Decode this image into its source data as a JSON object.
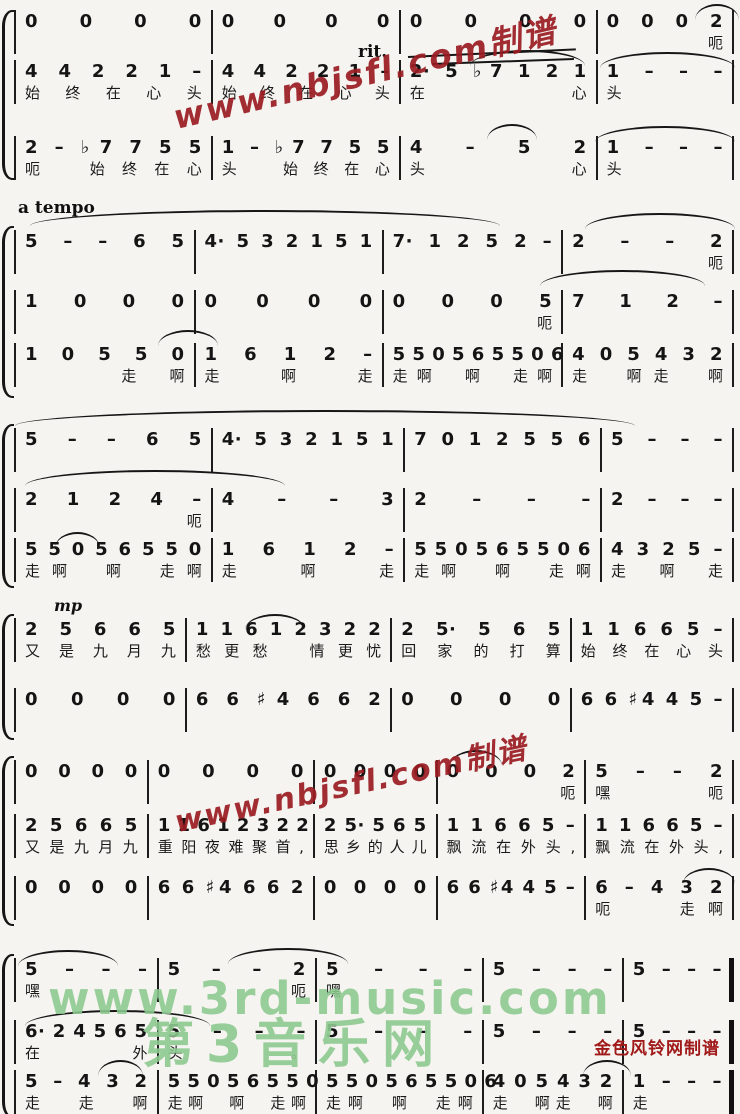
{
  "marks": {
    "rit": "rit.",
    "a_tempo": "a tempo",
    "mp": "mp"
  },
  "watermarks": {
    "red_diagonal_top": "www.nbjsfl.com制谱",
    "red_diagonal_mid": "www.nbjsfl.com制谱",
    "green_url": "www.3rd-music.com",
    "green_site_name": "第3音乐网",
    "red_credit": "金色风铃网制谱"
  },
  "colors": {
    "watermark_red": "#9a1c22",
    "watermark_green": "#8cc98f",
    "notation": "#141414",
    "background": "#f5f4f0"
  },
  "systems": [
    {
      "widths": [
        2.05,
        1.95,
        2.05,
        1.35
      ],
      "voices": [
        {
          "measures": [
            {
              "n": "0 0 0 0"
            },
            {
              "n": "0 0 0 0"
            },
            {
              "n": "0 0 0 0"
            },
            {
              "n": "0 0 0 2",
              "l": "　　　呃"
            }
          ]
        },
        {
          "measures": [
            {
              "n": "4 4 2 2 1 –",
              "l": "始终在心头"
            },
            {
              "n": "4 4 2 2 1 –",
              "l": "始终在心头"
            },
            {
              "n": "2· 5 ♭7 1 2 1",
              "l": "在　　心"
            },
            {
              "n": "1 – – –",
              "l": "头"
            }
          ]
        },
        {
          "measures": [
            {
              "n": "2 – ♭7 7 5 5",
              "l": "呃　始终在心"
            },
            {
              "n": "1 – ♭7 7 5 5",
              "l": "头　始终在心"
            },
            {
              "n": "4 – 5 2",
              "l": "头　心"
            },
            {
              "n": "1 – – –",
              "l": "头"
            }
          ]
        }
      ]
    },
    {
      "widths": [
        1.85,
        1.95,
        1.85,
        1.75
      ],
      "voices": [
        {
          "measures": [
            {
              "n": "5 – – 6 5"
            },
            {
              "n": "4· 5 3 2 1 5 1"
            },
            {
              "n": "7· 1 2 5 2 –"
            },
            {
              "n": "2 – – 2",
              "l": "　　　呃"
            }
          ]
        },
        {
          "measures": [
            {
              "n": "1 0 0 0"
            },
            {
              "n": "0 0 0 0"
            },
            {
              "n": "0 0 0 5",
              "l": "　　　呃"
            },
            {
              "n": "7 1 2 –"
            }
          ]
        },
        {
          "measures": [
            {
              "n": "1 0 5 5 0",
              "l": "　　走啊"
            },
            {
              "n": "1 6 1 2 –",
              "l": "走啊走"
            },
            {
              "n": "5 5 0 5 6 5 5 0 6",
              "l": "走啊　啊　走啊"
            },
            {
              "n": "4 0 5 4 3 2",
              "l": "走　啊走　啊"
            }
          ]
        }
      ]
    },
    {
      "widths": [
        2.05,
        2.0,
        2.05,
        1.3
      ],
      "voices": [
        {
          "measures": [
            {
              "n": "5 – – 6 5"
            },
            {
              "n": "4· 5 3 2 1 5 1"
            },
            {
              "n": "7 0 1 2 5 5 6"
            },
            {
              "n": "5 – – –"
            }
          ]
        },
        {
          "measures": [
            {
              "n": "2 1 2 4 –",
              "l": "　呃"
            },
            {
              "n": "4 – – 3"
            },
            {
              "n": "2 – – –"
            },
            {
              "n": "2 – – –"
            }
          ]
        },
        {
          "measures": [
            {
              "n": "5 5 0 5 6 5 5 0",
              "l": "走啊　啊　走啊"
            },
            {
              "n": "1 6 1 2 –",
              "l": "走啊走"
            },
            {
              "n": "5 5 0 5 6 5 5 0 6",
              "l": "走啊　啊　走啊"
            },
            {
              "n": "4 3 2 5 –",
              "l": "走　啊　走"
            }
          ]
        }
      ]
    },
    {
      "widths": [
        1.75,
        2.15,
        1.85,
        1.65
      ],
      "voices": [
        {
          "measures": [
            {
              "n": "2 5 6 6 5",
              "l": "又是九月九"
            },
            {
              "n": "1 1 6 1 2 3 2 2",
              "l": "愁更愁　情更忧"
            },
            {
              "n": "2 5· 5 6 5",
              "l": "回家的打算"
            },
            {
              "n": "1 1 6 6 5 –",
              "l": "始终在心头"
            }
          ]
        },
        {
          "measures": [
            {
              "n": "0 0 0 0"
            },
            {
              "n": "6 6 ♯4 6 6 2"
            },
            {
              "n": "0 0 0 0"
            },
            {
              "n": "6 6 ♯4 4 5 –"
            }
          ]
        }
      ]
    },
    {
      "widths": [
        1.35,
        1.75,
        1.23,
        1.54,
        1.53
      ],
      "voices": [
        {
          "measures": [
            {
              "n": "0 0 0 0"
            },
            {
              "n": "0 0 0 0"
            },
            {
              "n": "0 0 0 0"
            },
            {
              "n": "0 0 0 2",
              "l": "　　　呃"
            },
            {
              "n": "5 – – 2",
              "l": "嘿　　呃"
            }
          ]
        },
        {
          "measures": [
            {
              "n": "2 5 6 6 5",
              "l": "又是九月九"
            },
            {
              "n": "1 1 6 1 2 3 2 2",
              "l": "重阳夜难聚首,"
            },
            {
              "n": "2 5· 5 6 5",
              "l": "思乡的人儿"
            },
            {
              "n": "1 1 6 6 5 –",
              "l": "飘流在外头,"
            },
            {
              "n": "1 1 6 6 5 –",
              "l": "飘流在外头,"
            }
          ]
        },
        {
          "measures": [
            {
              "n": "0 0 0 0"
            },
            {
              "n": "6 6 ♯4 6 6 2"
            },
            {
              "n": "0 0 0 0"
            },
            {
              "n": "6 6 ♯4 4 5 –"
            },
            {
              "n": "6 – 4 3 2",
              "l": "呃　　走啊"
            }
          ]
        }
      ]
    },
    {
      "widths": [
        1.47,
        1.66,
        1.76,
        1.44,
        1.07
      ],
      "voices": [
        {
          "measures": [
            {
              "n": "5 – – –",
              "l": "嘿"
            },
            {
              "n": "5 – – 2",
              "l": "　　　呃"
            },
            {
              "n": "5 – – –",
              "l": "嘿"
            },
            {
              "n": "5 – – –"
            },
            {
              "n": "5 – – –"
            }
          ]
        },
        {
          "measures": [
            {
              "n": "6· 2 4 5 6 5",
              "l": "在　外"
            },
            {
              "n": "5 – – –",
              "l": "头。"
            },
            {
              "n": "5 – – –"
            },
            {
              "n": "5 – – –"
            },
            {
              "n": "5 – – –"
            }
          ]
        },
        {
          "measures": [
            {
              "n": "5 – 4 3 2",
              "l": "走　走　啊"
            },
            {
              "n": "5 5 0 5 6 5 5 0",
              "l": "走啊　啊　走啊"
            },
            {
              "n": "5 5 0 5 6 5 5 0 6",
              "l": "走啊　啊　走啊"
            },
            {
              "n": "4 0 5 4 3 2",
              "l": "走　啊走　啊"
            },
            {
              "n": "1 – – –",
              "l": "走"
            }
          ]
        }
      ]
    }
  ]
}
